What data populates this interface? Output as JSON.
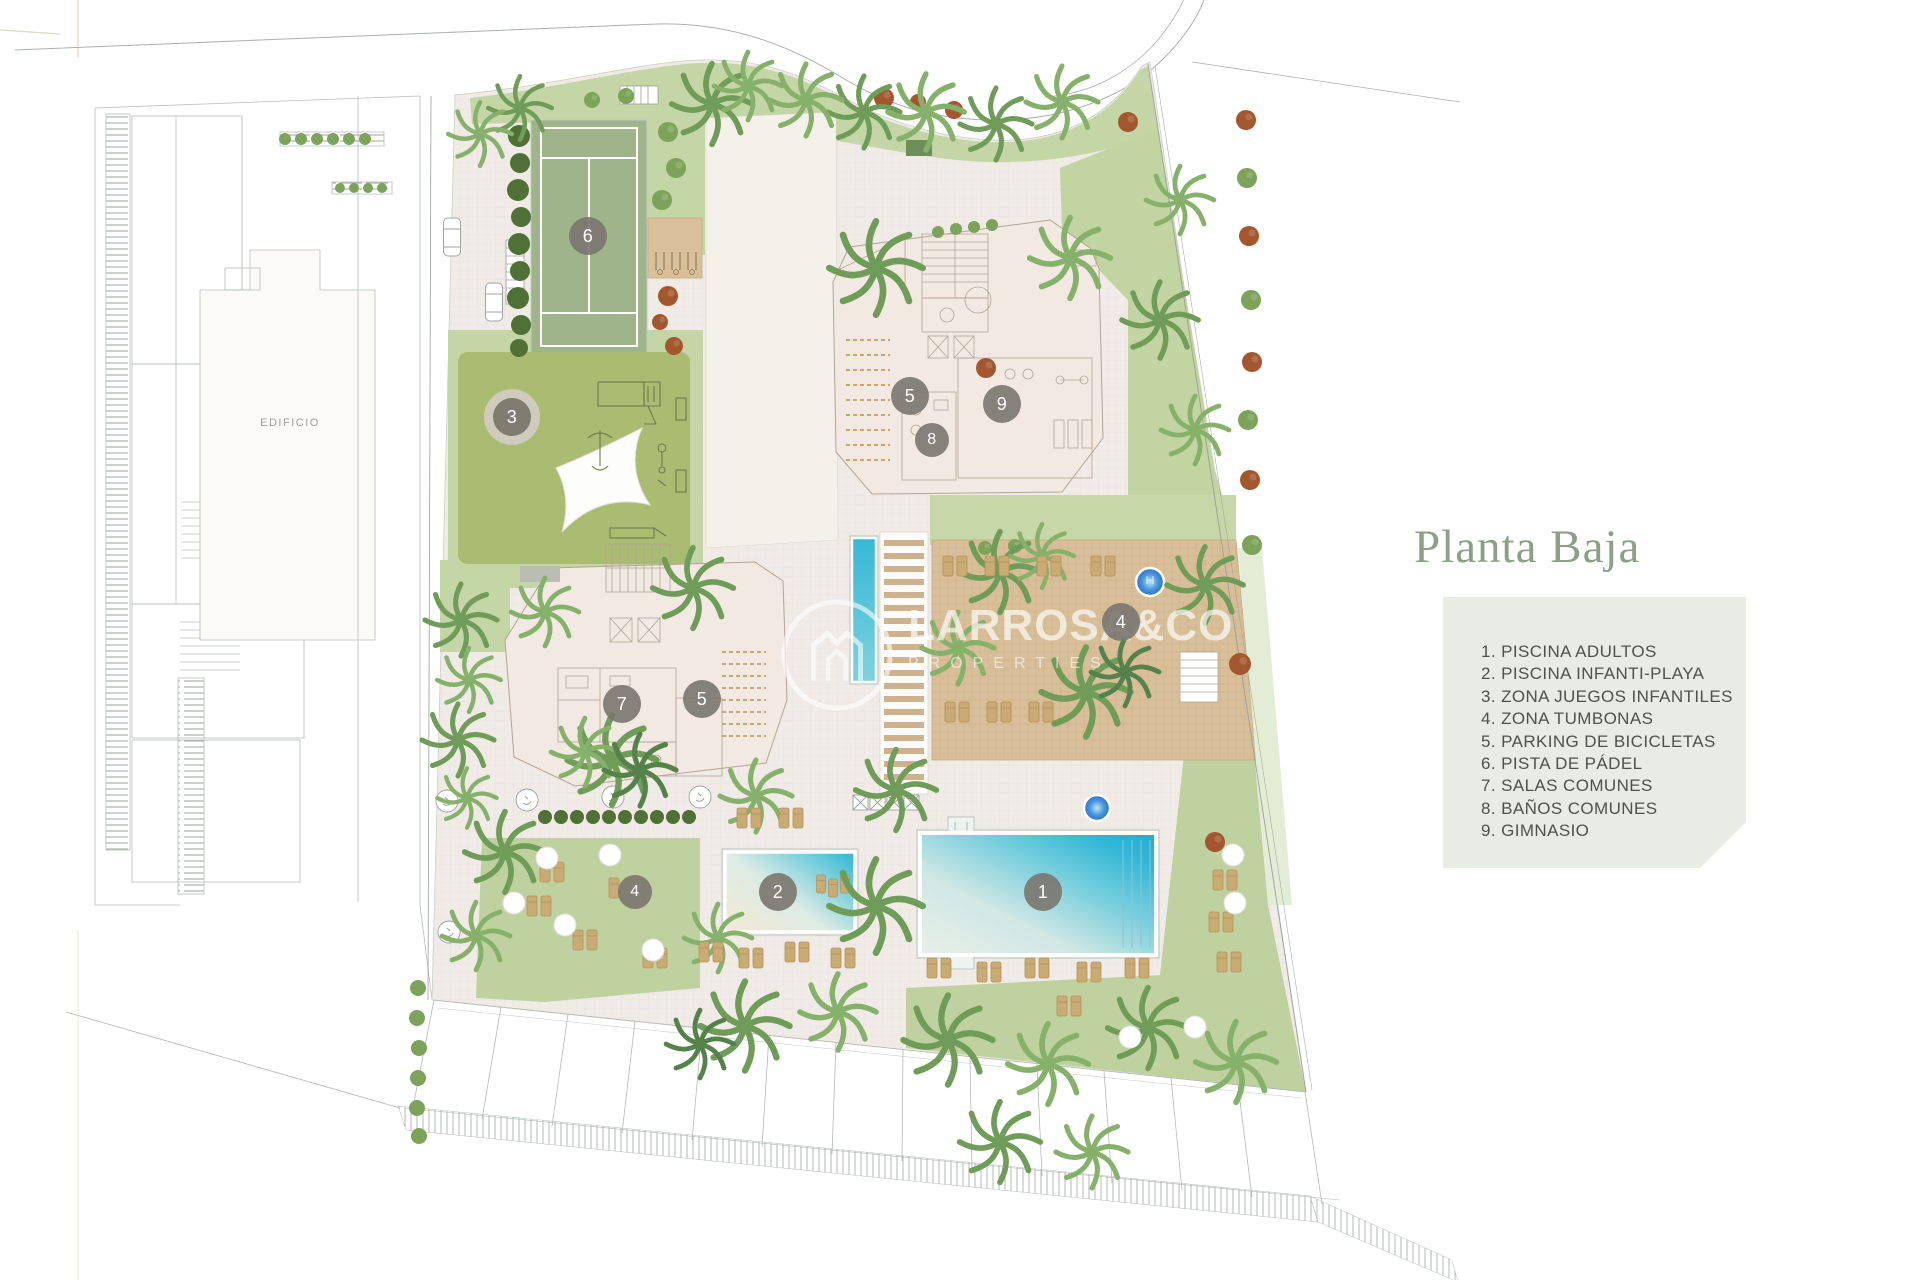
{
  "title": {
    "text": "Planta Baja"
  },
  "legend": {
    "items": [
      "1. PISCINA ADULTOS",
      "2. PISCINA INFANTI-PLAYA",
      "3. ZONA JUEGOS INFANTILES",
      "4. ZONA TUMBONAS",
      "5. PARKING DE BICICLETAS",
      "6. PISTA DE PÁDEL",
      "7. SALAS COMUNES",
      "8. BAÑOS COMUNES",
      "9. GIMNASIO"
    ]
  },
  "watermark": {
    "brand": "LARROSA&CO",
    "sub": "PROPERTIES"
  },
  "plan": {
    "edificio_label": "EDIFICIO",
    "markers": [
      {
        "n": "6"
      },
      {
        "n": "3"
      },
      {
        "n": "5"
      },
      {
        "n": "9"
      },
      {
        "n": "8"
      },
      {
        "n": "7"
      },
      {
        "n": "5"
      },
      {
        "n": "4"
      },
      {
        "n": "2"
      },
      {
        "n": "1"
      },
      {
        "n": "4"
      }
    ]
  },
  "colors": {
    "title": "#8ca086",
    "legend_bg": "#e9ece4",
    "legend_text": "#4d524e",
    "marker": "rgba(122,118,111,0.9)",
    "lawn": "#c4d6a6",
    "playground": "#a9bc72",
    "padel": "#9fb48b",
    "deck": "#d9c09a",
    "pool": "#2db5d5",
    "building": "#f2e9e2"
  }
}
